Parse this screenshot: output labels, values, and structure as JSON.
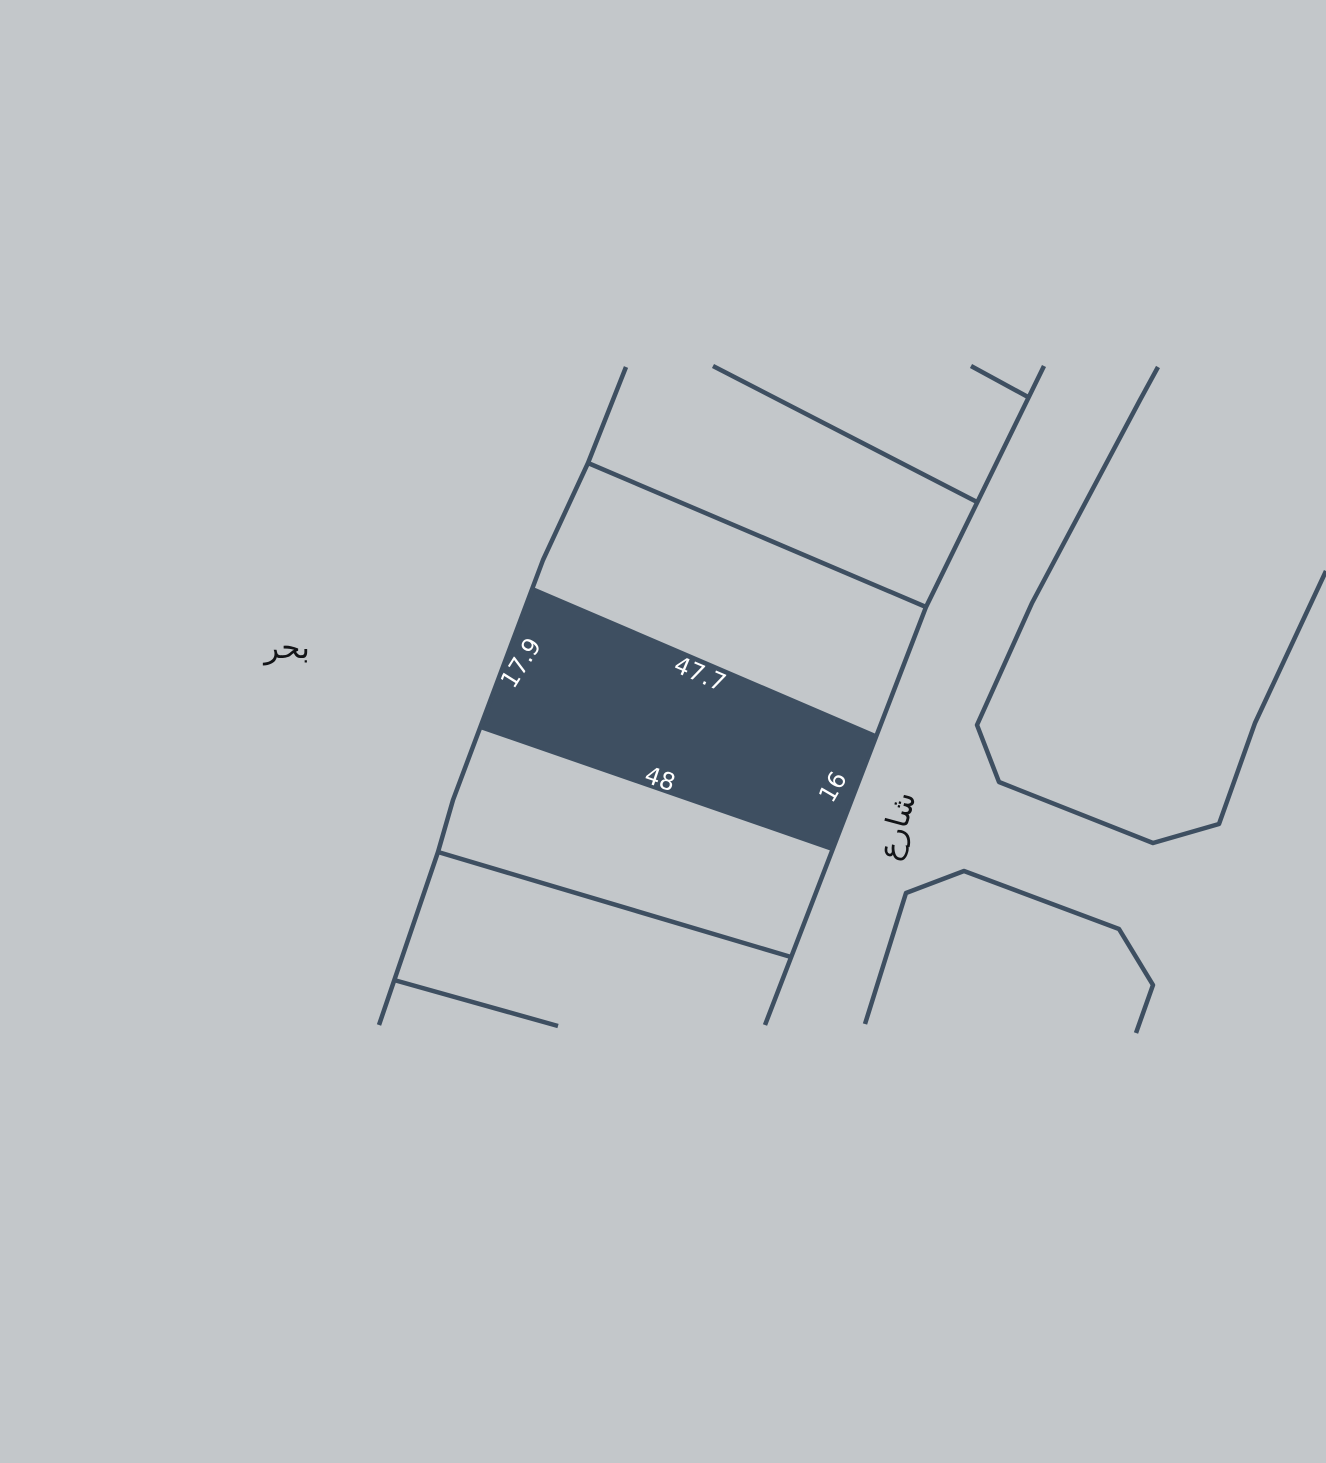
{
  "map": {
    "type": "cadastral-plot-map",
    "colors": {
      "background": "#c3c7ca",
      "line": "#3e4f61",
      "highlight_fill": "#3e4f61",
      "dimension_text": "#ffffff",
      "area_label_text": "#121417"
    },
    "area_labels": {
      "sea": "بحر",
      "street": "شارع"
    },
    "highlighted_parcel": {
      "side_left": "17.9",
      "side_top": "47.7",
      "side_bottom": "48",
      "side_right": "16"
    }
  }
}
